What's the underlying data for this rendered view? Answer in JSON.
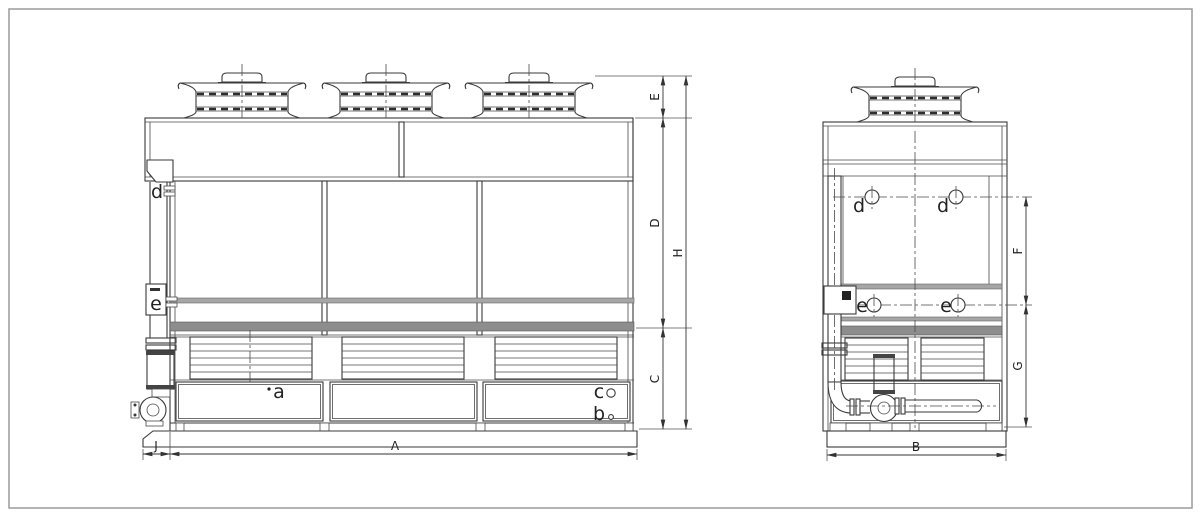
{
  "drawing": {
    "kind": "technical line drawing, two orthographic views of a closed-circuit cooling tower with pump and piping",
    "views": {
      "front": {
        "dims": {
          "A": "A",
          "C": "C",
          "D": "D",
          "E": "E",
          "H": "H",
          "J": "J"
        },
        "labels": {
          "a": "a",
          "b": "b",
          "c": "c",
          "d": "d",
          "e": "e"
        }
      },
      "side": {
        "dims": {
          "B": "B",
          "F": "F",
          "G": "G"
        },
        "labels": {
          "d": "d",
          "e": "e"
        }
      }
    }
  }
}
